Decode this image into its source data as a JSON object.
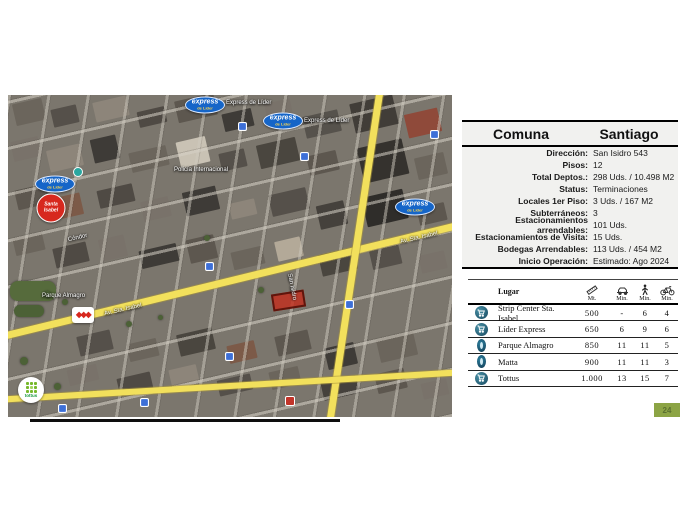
{
  "page": {
    "number": "24"
  },
  "info_table": {
    "header": {
      "label": "Comuna",
      "value": "Santiago"
    },
    "rows": [
      {
        "label": "Dirección:",
        "value": "San Isidro 543"
      },
      {
        "label": "Pisos:",
        "value": "12"
      },
      {
        "label": "Total Deptos.:",
        "value": "298 Uds. / 10.498 M2"
      },
      {
        "label": "Status:",
        "value": "Terminaciones"
      },
      {
        "label": "Locales 1er Piso:",
        "value": "3 Uds. / 167 M2"
      },
      {
        "label": "Subterráneos:",
        "value": "3"
      },
      {
        "label": "Estacionamientos arrendables:",
        "value": "101 Uds."
      },
      {
        "label": "Estacionamientos de Visita:",
        "value": "15 Uds."
      },
      {
        "label": "Bodegas Arrendables:",
        "value": "113 Uds. / 454 M2"
      },
      {
        "label": "Inicio Operación:",
        "value": "Estimado: Ago 2024"
      }
    ]
  },
  "distance_table": {
    "place_header": "Lugar",
    "columns": [
      {
        "name": "distance",
        "unit": "Mt."
      },
      {
        "name": "car",
        "unit": "Min."
      },
      {
        "name": "walk",
        "unit": "Min."
      },
      {
        "name": "bike",
        "unit": "Min."
      }
    ],
    "rows": [
      {
        "place": "Strip Center Sta. Isabel",
        "mt": "500",
        "car": "-",
        "walk": "6",
        "bike": "4"
      },
      {
        "place": "Líder Express",
        "mt": "650",
        "car": "6",
        "walk": "9",
        "bike": "6"
      },
      {
        "place": "Parque Almagro",
        "mt": "850",
        "car": "11",
        "walk": "11",
        "bike": "5"
      },
      {
        "place": "Matta",
        "mt": "900",
        "car": "11",
        "walk": "11",
        "bike": "3"
      },
      {
        "place": "Tottus",
        "mt": "1.000",
        "car": "13",
        "walk": "15",
        "bike": "7"
      }
    ]
  },
  "map": {
    "badges": {
      "express": "express",
      "express_sub": "de Líder",
      "santa_isabel": "Santa Isabel",
      "diamonds": "◆◆◆",
      "tottus": "tottus"
    },
    "labels": [
      "Express de Líder",
      "Express de Líder",
      "Policía Internacional",
      "Cóndor",
      "Av. Sta. Isabel",
      "Av. Sta. Isabel",
      "Parque Almagro",
      "San Isidro"
    ]
  },
  "colors": {
    "road_yellow": "#f2e05c",
    "express_blue": "#1565c8",
    "santa_isabel_red": "#d7281e",
    "site_red": "#c42d1b",
    "accent_green": "#8ca445"
  }
}
